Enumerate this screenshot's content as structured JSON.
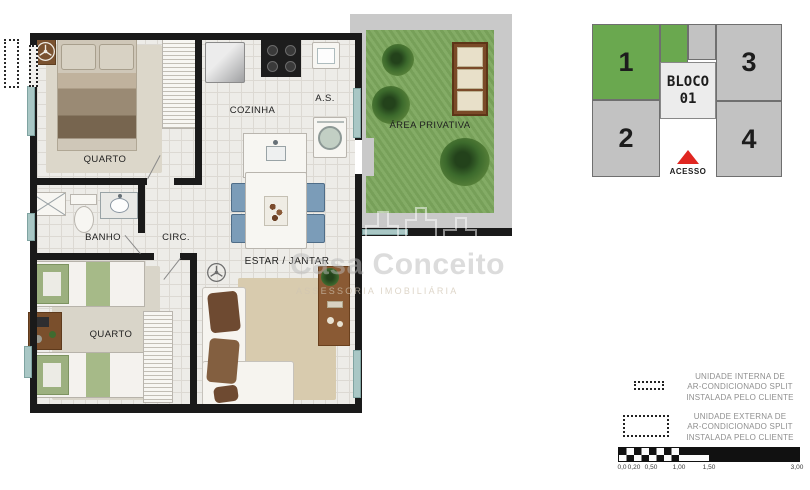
{
  "floor_plan": {
    "rooms": [
      {
        "label": "QUARTO"
      },
      {
        "label": "COZINHA"
      },
      {
        "label": "A.S."
      },
      {
        "label": "ÁREA PRIVATIVA"
      },
      {
        "label": "BANHO"
      },
      {
        "label": "CIRC."
      },
      {
        "label": "ESTAR / JANTAR"
      },
      {
        "label": "QUARTO"
      }
    ],
    "colors": {
      "wall": "#1a1a1a",
      "floor": "#edece8",
      "window": "#a9c7c5",
      "garden": "#7da85e",
      "sidewalk": "#c9c9c9"
    }
  },
  "key_plan": {
    "block_label_line1": "BLOCO",
    "block_label_line2": "01",
    "units": [
      {
        "number": "1",
        "highlighted": true
      },
      {
        "number": "2",
        "highlighted": false
      },
      {
        "number": "3",
        "highlighted": false
      },
      {
        "number": "4",
        "highlighted": false
      }
    ],
    "access_label": "ACESSO",
    "colors": {
      "highlighted_unit": "#6aa84f",
      "unit": "#c2c2c2",
      "access_arrow": "#e02620"
    }
  },
  "legend": {
    "items": [
      {
        "symbol": "internal-ac-dashed-outline",
        "lines": [
          "UNIDADE INTERNA DE",
          "AR-CONDICIONADO SPLIT",
          "INSTALADA PELO CLIENTE"
        ]
      },
      {
        "symbol": "external-ac-dashed-outline",
        "lines": [
          "UNIDADE EXTERNA DE",
          "AR-CONDICIONADO SPLIT",
          "INSTALADA PELO CLIENTE"
        ]
      }
    ]
  },
  "scale_bar": {
    "labels": [
      "0,0",
      "0,20",
      "0,50",
      "1,00",
      "1,50",
      "3,00"
    ]
  },
  "watermark": {
    "name": "Casa Conceito",
    "tagline": "ASSESSORIA IMOBILIÁRIA"
  }
}
